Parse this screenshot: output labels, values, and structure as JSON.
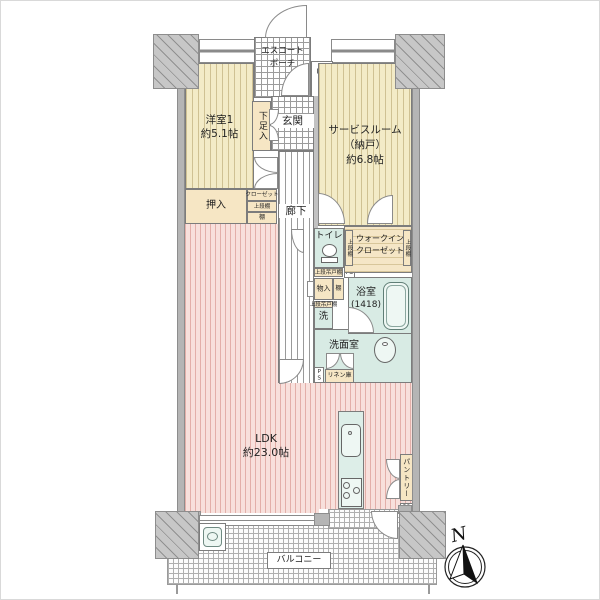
{
  "colors": {
    "tatami": "#f3ebc7",
    "tatami_stripe": "#cfc193",
    "ldk_floor": "#f8e0dc",
    "ldk_stripe": "#e3afa9",
    "wet_area": "#d8ebe4",
    "closet": "#f6e6c4",
    "wall": "#b5b5b5"
  },
  "labels": {
    "escort_porch_line1": "エスコート",
    "escort_porch_line2": "ポーチ",
    "mb": "MB",
    "ps": "PS",
    "western_room_name": "洋室1",
    "western_room_size": "約5.1帖",
    "shoe_cabinet": "下足入",
    "entrance": "玄関",
    "service_room_line1": "サービスルーム",
    "service_room_line2": "（納戸）",
    "service_room_line3": "約6.8帖",
    "oshiire": "押入",
    "closet": "クローゼット",
    "closet_upper_shelf": "上段棚",
    "closet_shelf": "棚",
    "corridor": "廊下",
    "toilet": "トイレ",
    "toilet_upper_cabinet": "上段吊戸棚",
    "toilet_ps": "PS",
    "wic_line1": "ウォークイン",
    "wic_line2": "クローゼット",
    "wic_shelf_left": "上段棚",
    "wic_shelf_right": "上段棚",
    "storage": "物入",
    "storage_shelf": "棚",
    "bathroom_name": "浴室",
    "bathroom_size": "(1418)",
    "laundry_upper_cabinet": "上段吊戸棚",
    "laundry": "洗",
    "washroom": "洗面室",
    "washroom_ps": "PS",
    "linen_cabinet": "リネン庫",
    "ldk_name": "LDK",
    "ldk_size": "約23.0帖",
    "pantry": "パントリー",
    "kitchen_ps": "PS",
    "balcony": "バルコニー",
    "compass_north": "N"
  }
}
